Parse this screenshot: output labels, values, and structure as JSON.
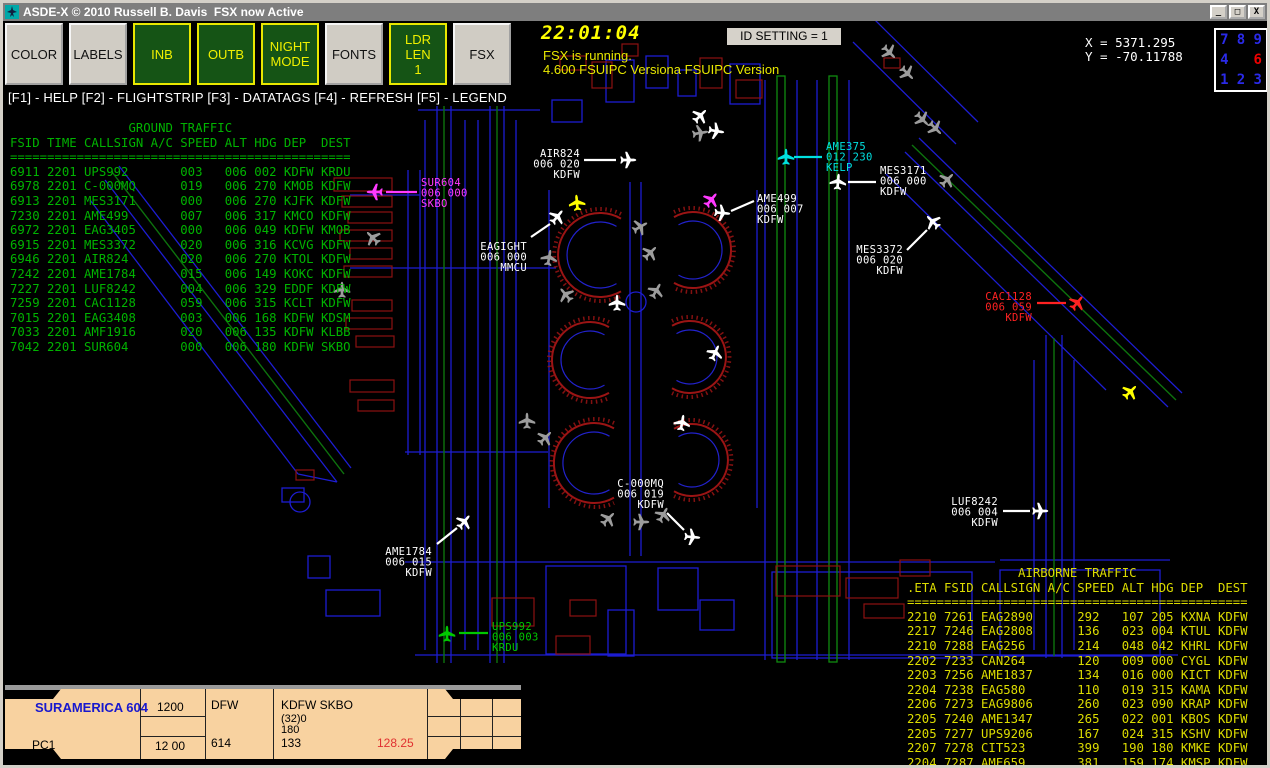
{
  "window": {
    "title": "ASDE-X © 2010 Russell B. Davis  FSX now Active",
    "controls": {
      "minimize": "_",
      "maximize": "□",
      "close": "X"
    }
  },
  "toolbar": {
    "buttons": [
      {
        "label": "COLOR",
        "style": "gray"
      },
      {
        "label": "LABELS",
        "style": "gray"
      },
      {
        "label": "INB",
        "style": "green"
      },
      {
        "label": "OUTB",
        "style": "green"
      },
      {
        "label": "NIGHT\nMODE",
        "style": "green"
      },
      {
        "label": "FONTS",
        "style": "gray"
      },
      {
        "label": "LDR\nLEN\n1",
        "style": "green"
      },
      {
        "label": "FSX",
        "style": "gray"
      }
    ]
  },
  "status": {
    "clock": "22:01:04",
    "line1": "FSX is running.",
    "line2": "4.600 FSUIPC Versiona FSUIPC Version",
    "id_setting": "ID SETTING = 1",
    "x_coord": "X = 5371.295",
    "y_coord": "Y = -70.11788"
  },
  "numpad": {
    "keys": [
      {
        "label": "7",
        "color": "#2A2AE8"
      },
      {
        "label": "8",
        "color": "#2A2AE8"
      },
      {
        "label": "9",
        "color": "#2A2AE8"
      },
      {
        "label": "4",
        "color": "#2A2AE8"
      },
      {
        "label": "",
        "color": ""
      },
      {
        "label": "6",
        "color": "#F00000"
      },
      {
        "label": "1",
        "color": "#2A2AE8"
      },
      {
        "label": "2",
        "color": "#2A2AE8"
      },
      {
        "label": "3",
        "color": "#2A2AE8"
      }
    ]
  },
  "function_bar": "[F1] - HELP [F2] - FLIGHTSTRIP [F3] - DATATAGS [F4] - REFRESH [F5] - LEGEND",
  "ground_traffic": {
    "title": "GROUND TRAFFIC",
    "header": "FSID TIME CALLSIGN A/C SPEED ALT HDG DEP  DEST",
    "rows": [
      [
        "6911",
        "2201",
        "UPS992",
        "",
        "003",
        "006",
        "002",
        "KDFW",
        "KRDU"
      ],
      [
        "6978",
        "2201",
        "C-000MQ",
        "",
        "019",
        "006",
        "270",
        "KMOB",
        "KDFW"
      ],
      [
        "6913",
        "2201",
        "MES3171",
        "",
        "000",
        "006",
        "270",
        "KJFK",
        "KDFW"
      ],
      [
        "7230",
        "2201",
        "AME499",
        "",
        "007",
        "006",
        "317",
        "KMCO",
        "KDFW"
      ],
      [
        "6972",
        "2201",
        "EAG3405",
        "",
        "000",
        "006",
        "049",
        "KDFW",
        "KMOB"
      ],
      [
        "6915",
        "2201",
        "MES3372",
        "",
        "020",
        "006",
        "316",
        "KCVG",
        "KDFW"
      ],
      [
        "6946",
        "2201",
        "AIR824",
        "",
        "020",
        "006",
        "270",
        "KTOL",
        "KDFW"
      ],
      [
        "7242",
        "2201",
        "AME1784",
        "",
        "015",
        "006",
        "149",
        "KOKC",
        "KDFW"
      ],
      [
        "7227",
        "2201",
        "LUF8242",
        "",
        "004",
        "006",
        "329",
        "EDDF",
        "KDFW"
      ],
      [
        "7259",
        "2201",
        "CAC1128",
        "",
        "059",
        "006",
        "315",
        "KCLT",
        "KDFW"
      ],
      [
        "7015",
        "2201",
        "EAG3408",
        "",
        "003",
        "006",
        "168",
        "KDFW",
        "KDSM"
      ],
      [
        "7033",
        "2201",
        "AMF1916",
        "",
        "020",
        "006",
        "135",
        "KDFW",
        "KLBB"
      ],
      [
        "7042",
        "2201",
        "SUR604",
        "",
        "000",
        "006",
        "180",
        "KDFW",
        "SKBO"
      ]
    ]
  },
  "airborne_traffic": {
    "title": "AIRBORNE TRAFFIC",
    "header": ".ETA FSID CALLSIGN A/C SPEED ALT HDG DEP  DEST",
    "rows": [
      [
        "2210",
        "7261",
        "EAG2890",
        "",
        "292",
        "107",
        "205",
        "KXNA",
        "KDFW"
      ],
      [
        "2217",
        "7246",
        "EAG2808",
        "",
        "136",
        "023",
        "004",
        "KTUL",
        "KDFW"
      ],
      [
        "2210",
        "7288",
        "EAG256",
        "",
        "214",
        "048",
        "042",
        "KHRL",
        "KDFW"
      ],
      [
        "2202",
        "7233",
        "CAN264",
        "",
        "120",
        "009",
        "000",
        "CYGL",
        "KDFW"
      ],
      [
        "2203",
        "7256",
        "AME1837",
        "",
        "134",
        "016",
        "000",
        "KICT",
        "KDFW"
      ],
      [
        "2204",
        "7238",
        "EAG580",
        "",
        "110",
        "019",
        "315",
        "KAMA",
        "KDFW"
      ],
      [
        "2206",
        "7273",
        "EAG9806",
        "",
        "260",
        "023",
        "090",
        "KRAP",
        "KDFW"
      ],
      [
        "2205",
        "7240",
        "AME1347",
        "",
        "265",
        "022",
        "001",
        "KBOS",
        "KDFW"
      ],
      [
        "2205",
        "7277",
        "UPS9206",
        "",
        "167",
        "024",
        "315",
        "KSHV",
        "KDFW"
      ],
      [
        "2207",
        "7278",
        "CIT523",
        "",
        "399",
        "190",
        "180",
        "KMKE",
        "KDFW"
      ],
      [
        "2204",
        "7287",
        "AME659",
        "",
        "381",
        "159",
        "174",
        "KMSP",
        "KDFW"
      ]
    ]
  },
  "flight_strip": {
    "callsign": "SURAMERICA 604",
    "position": "PC1",
    "squawk": "1200",
    "squawk2": "12 00",
    "dep_code": "DFW",
    "strip_number": "614",
    "route": "KDFW SKBO",
    "alt_line1": "(32)0",
    "alt_line2": "180",
    "alt_line3": "133",
    "frequency": "128.25"
  },
  "map": {
    "tags": [
      {
        "lines": [
          "AIR824",
          "006 020",
          "KDFW"
        ],
        "color": "#FFFFFF",
        "align": "end",
        "x": 580,
        "y": 147,
        "leader": [
          584,
          160,
          616,
          160
        ]
      },
      {
        "lines": [
          "AME375",
          "012 230",
          "KELP"
        ],
        "color": "#00E0E0",
        "align": "start",
        "x": 826,
        "y": 140,
        "leader": [
          794,
          157,
          822,
          157
        ]
      },
      {
        "lines": [
          "MES3171",
          "006 000",
          "KDFW"
        ],
        "color": "#FFFFFF",
        "align": "start",
        "x": 880,
        "y": 164,
        "leader": [
          848,
          182,
          876,
          182
        ]
      },
      {
        "lines": [
          "SUR604",
          "006 000",
          "SKBO"
        ],
        "color": "#FF3AFF",
        "align": "start",
        "x": 421,
        "y": 176,
        "leader": [
          386,
          192,
          417,
          192
        ]
      },
      {
        "lines": [
          "AME499",
          "006 007",
          "KDFW"
        ],
        "color": "#FFFFFF",
        "align": "start",
        "x": 757,
        "y": 192,
        "leader": [
          731,
          211,
          754,
          201
        ]
      },
      {
        "lines": [
          "EAGIGHT",
          "006 000",
          "MMCU"
        ],
        "color": "#FFFFFF",
        "align": "end",
        "x": 527,
        "y": 240,
        "leader": [
          531,
          237,
          550,
          224
        ]
      },
      {
        "lines": [
          "MES3372",
          "006 020",
          "KDFW"
        ],
        "color": "#FFFFFF",
        "align": "end",
        "x": 903,
        "y": 243,
        "leader": [
          907,
          250,
          927,
          230
        ]
      },
      {
        "lines": [
          "CAC1128",
          "006 059",
          "KDFW"
        ],
        "color": "#FF2222",
        "align": "end",
        "x": 1032,
        "y": 290,
        "leader": [
          1037,
          303,
          1066,
          303
        ]
      },
      {
        "lines": [
          "LUF8242",
          "006 004",
          "KDFW"
        ],
        "color": "#FFFFFF",
        "align": "end",
        "x": 998,
        "y": 495,
        "leader": [
          1003,
          511,
          1030,
          511
        ]
      },
      {
        "lines": [
          "C-000MQ",
          "006 019",
          "KDFW"
        ],
        "color": "#FFFFFF",
        "align": "end",
        "x": 664,
        "y": 477,
        "leader": [
          667,
          513,
          684,
          530
        ]
      },
      {
        "lines": [
          "AME1784",
          "006 015",
          "KDFW"
        ],
        "color": "#FFFFFF",
        "align": "end",
        "x": 432,
        "y": 545,
        "leader": [
          437,
          544,
          457,
          528
        ]
      },
      {
        "lines": [
          "UPS992",
          "006 003",
          "KRDU"
        ],
        "color": "#00C800",
        "align": "start",
        "x": 492,
        "y": 620,
        "leader": [
          459,
          633,
          488,
          633
        ]
      }
    ],
    "aircraft": [
      {
        "x": 628,
        "y": 160,
        "r": 90,
        "c": "#FFFFFF"
      },
      {
        "x": 838,
        "y": 182,
        "r": 5,
        "c": "#FFFFFF"
      },
      {
        "x": 722,
        "y": 213,
        "r": 95,
        "c": "#FFFFFF"
      },
      {
        "x": 557,
        "y": 217,
        "r": 40,
        "c": "#FFFFFF"
      },
      {
        "x": 933,
        "y": 222,
        "r": -45,
        "c": "#FFFFFF"
      },
      {
        "x": 1040,
        "y": 511,
        "r": 90,
        "c": "#FFFFFF"
      },
      {
        "x": 692,
        "y": 537,
        "r": 95,
        "c": "#FFFFFF"
      },
      {
        "x": 464,
        "y": 522,
        "r": 40,
        "c": "#FFFFFF"
      },
      {
        "x": 617,
        "y": 303,
        "r": 0,
        "c": "#FFFFFF"
      },
      {
        "x": 682,
        "y": 423,
        "r": 10,
        "c": "#FFFFFF"
      },
      {
        "x": 715,
        "y": 353,
        "r": 25,
        "c": "#FFFFFF"
      },
      {
        "x": 700,
        "y": 116,
        "r": 45,
        "c": "#FFFFFF"
      },
      {
        "x": 716,
        "y": 131,
        "r": 100,
        "c": "#FFFFFF"
      },
      {
        "x": 786,
        "y": 157,
        "r": 0,
        "c": "#00E0E0"
      },
      {
        "x": 375,
        "y": 192,
        "r": 270,
        "c": "#FF3AFF"
      },
      {
        "x": 711,
        "y": 200,
        "r": 40,
        "c": "#FF3AFF"
      },
      {
        "x": 1077,
        "y": 303,
        "r": 40,
        "c": "#FF2222"
      },
      {
        "x": 577,
        "y": 203,
        "r": 355,
        "c": "#FFFF00"
      },
      {
        "x": 1130,
        "y": 392,
        "r": 45,
        "c": "#FFFF00"
      },
      {
        "x": 447,
        "y": 634,
        "r": 0,
        "c": "#00C800"
      },
      {
        "x": 373,
        "y": 238,
        "r": 315,
        "c": "#9C9C9C"
      },
      {
        "x": 342,
        "y": 290,
        "r": 0,
        "c": "#9C9C9C"
      },
      {
        "x": 566,
        "y": 295,
        "r": 320,
        "c": "#9C9C9C"
      },
      {
        "x": 549,
        "y": 258,
        "r": 10,
        "c": "#9C9C9C"
      },
      {
        "x": 640,
        "y": 227,
        "r": 60,
        "c": "#9C9C9C"
      },
      {
        "x": 650,
        "y": 253,
        "r": 45,
        "c": "#9C9C9C"
      },
      {
        "x": 656,
        "y": 291,
        "r": 30,
        "c": "#9C9C9C"
      },
      {
        "x": 527,
        "y": 421,
        "r": 0,
        "c": "#9C9C9C"
      },
      {
        "x": 545,
        "y": 438,
        "r": 45,
        "c": "#9C9C9C"
      },
      {
        "x": 608,
        "y": 519,
        "r": 45,
        "c": "#9C9C9C"
      },
      {
        "x": 641,
        "y": 522,
        "r": 90,
        "c": "#9C9C9C"
      },
      {
        "x": 663,
        "y": 515,
        "r": 30,
        "c": "#9C9C9C"
      },
      {
        "x": 889,
        "y": 52,
        "r": 135,
        "c": "#9C9C9C"
      },
      {
        "x": 907,
        "y": 73,
        "r": 135,
        "c": "#9C9C9C"
      },
      {
        "x": 922,
        "y": 119,
        "r": 135,
        "c": "#9C9C9C"
      },
      {
        "x": 935,
        "y": 128,
        "r": 135,
        "c": "#9C9C9C"
      },
      {
        "x": 700,
        "y": 133,
        "r": 80,
        "c": "#9C9C9C"
      },
      {
        "x": 947,
        "y": 180,
        "r": 45,
        "c": "#9C9C9C"
      }
    ],
    "palette": {
      "taxiway_blue": "#1D1DD2",
      "building_red": "#8D1212",
      "runway_green": "#0D720D",
      "ground_text": "#00B300",
      "airborne_text": "#DCDC00"
    }
  }
}
